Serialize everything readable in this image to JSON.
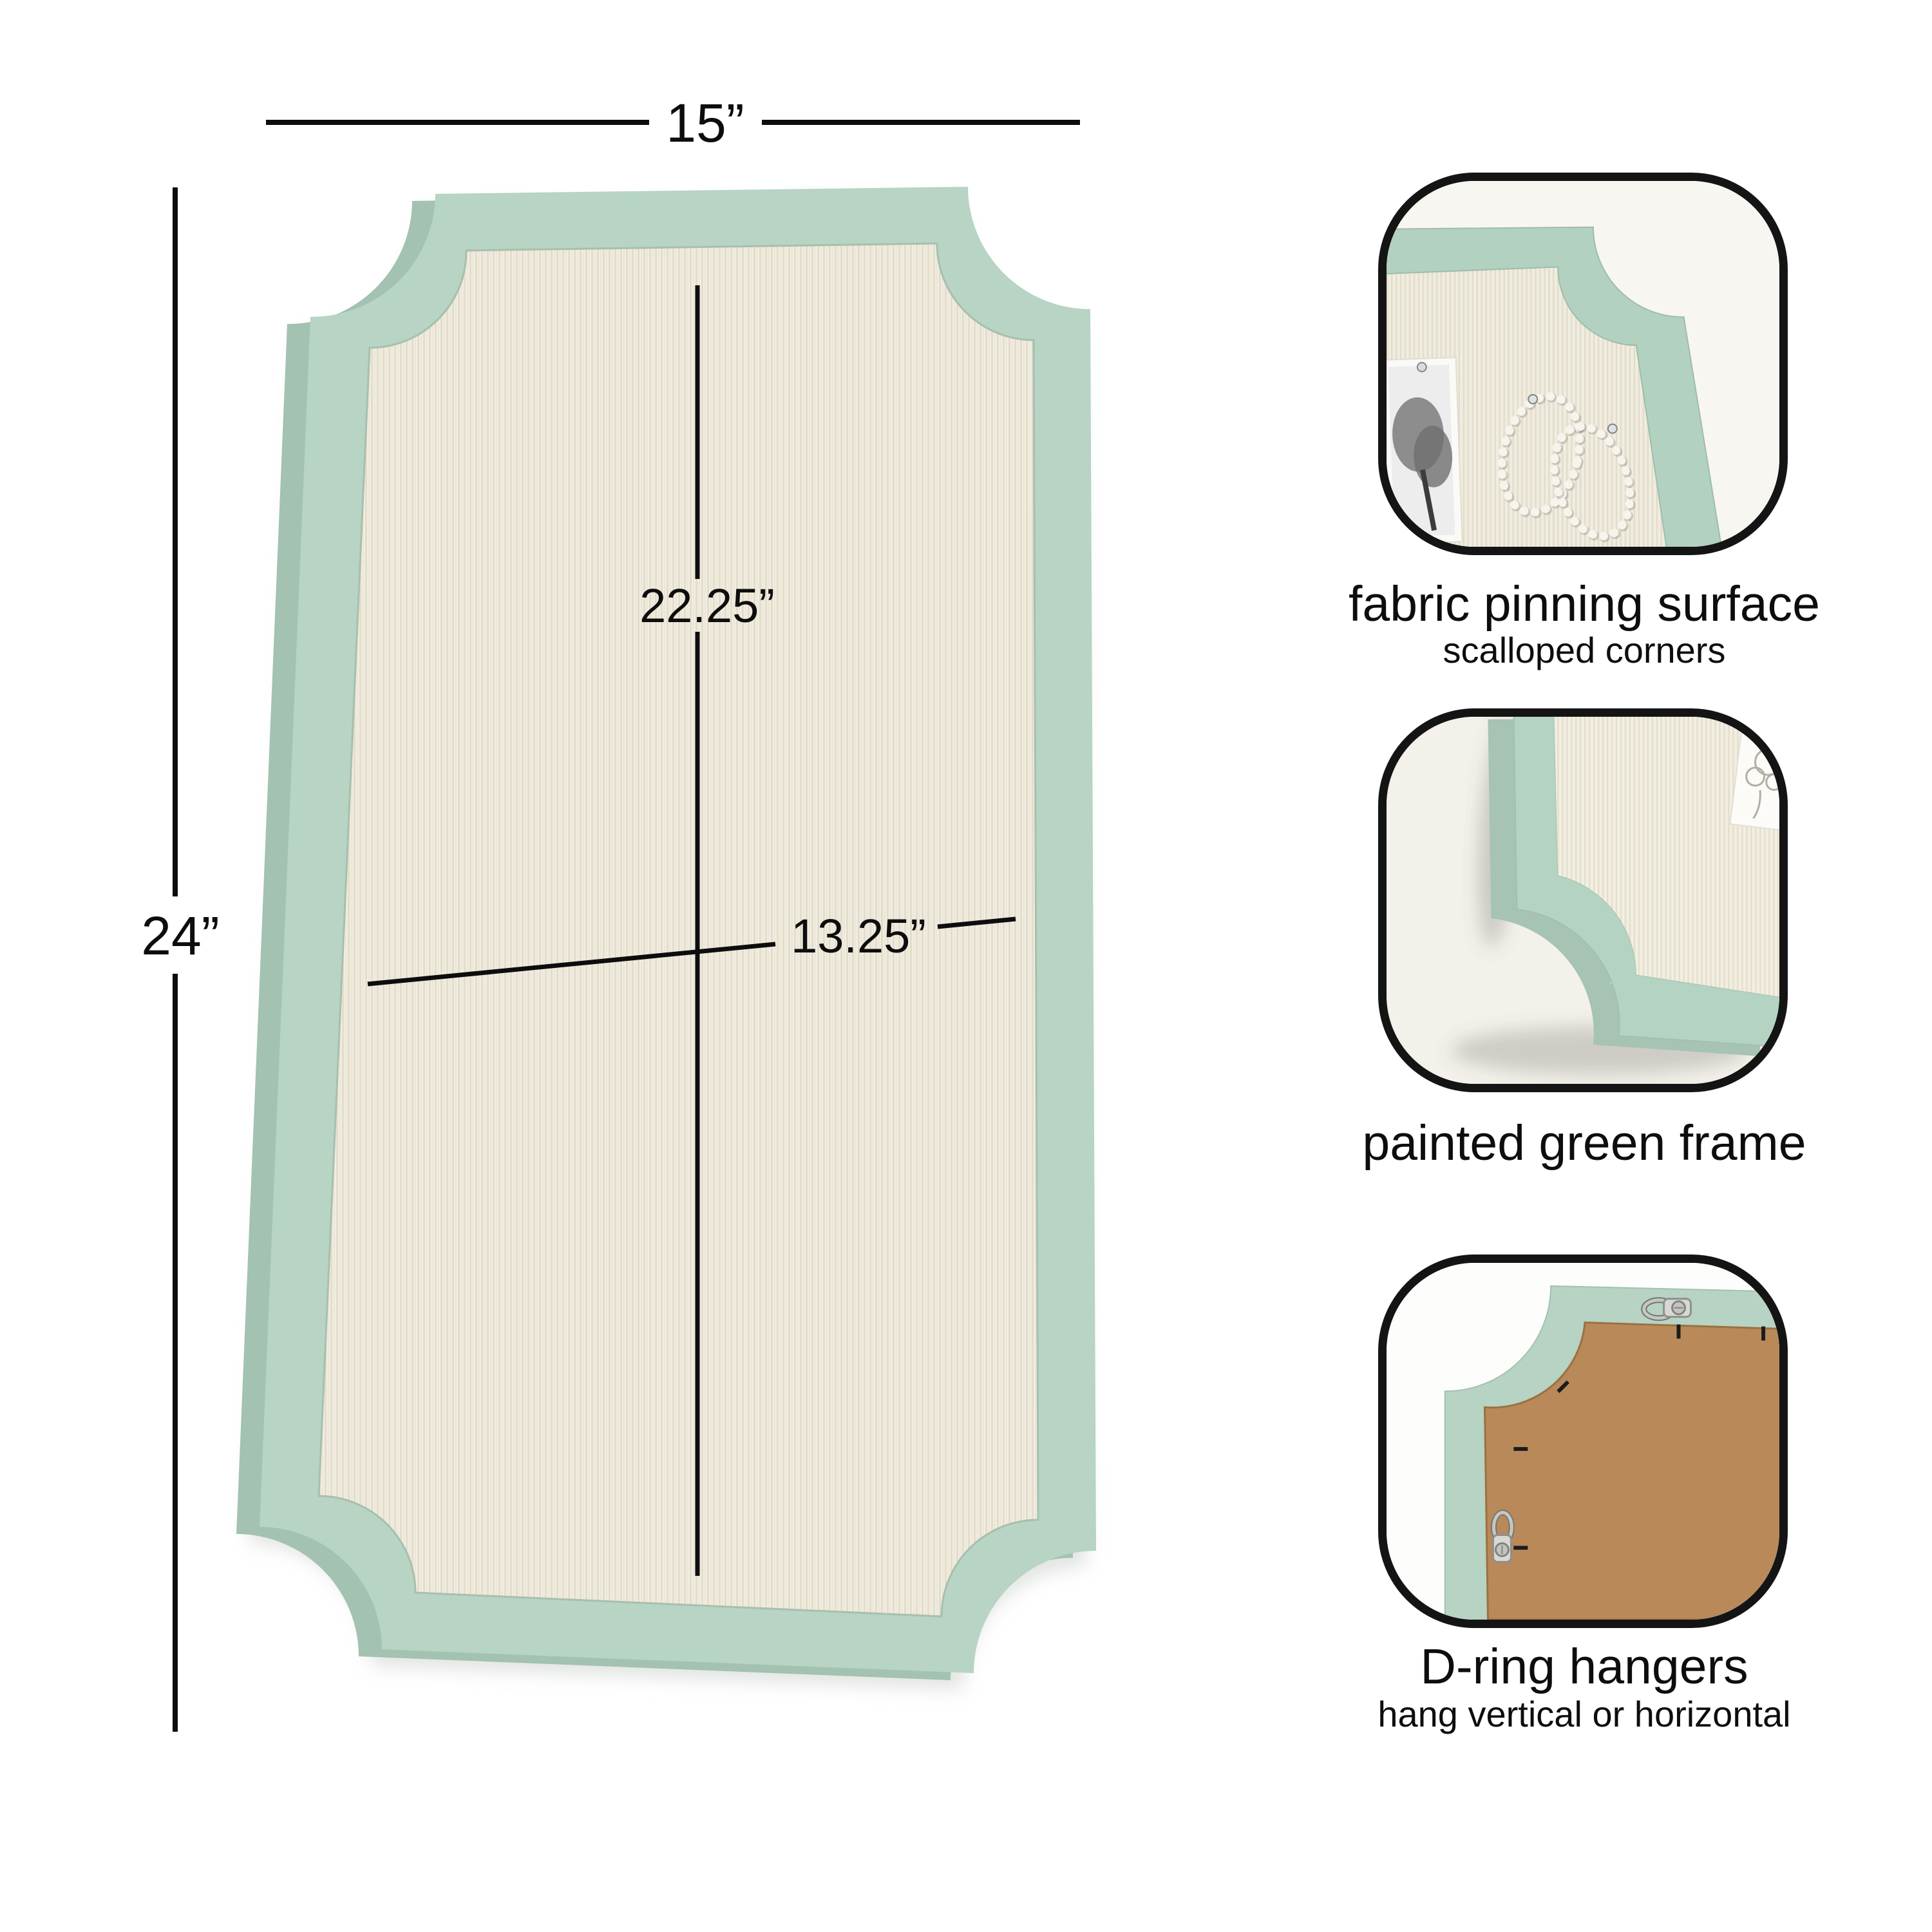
{
  "dimensions": {
    "overall_width": "15”",
    "overall_height": "24”",
    "fabric_height": "22.25”",
    "fabric_width": "13.25”"
  },
  "callouts": [
    {
      "caption": "fabric pinning surface",
      "subcaption": "scalloped corners"
    },
    {
      "caption": "painted green frame"
    },
    {
      "caption": "D-ring hangers",
      "subcaption": "hang vertical or horizontal"
    }
  ],
  "colors": {
    "frame_green": "#b7d4c4",
    "frame_green_edge": "#a3c2b1",
    "fabric_cream": "#f0ecdf",
    "fabric_weave": "#e0dac8",
    "backing_brown": "#b9895a",
    "annotation_black": "#0d0d0d",
    "callout_border_black": "#141414"
  }
}
